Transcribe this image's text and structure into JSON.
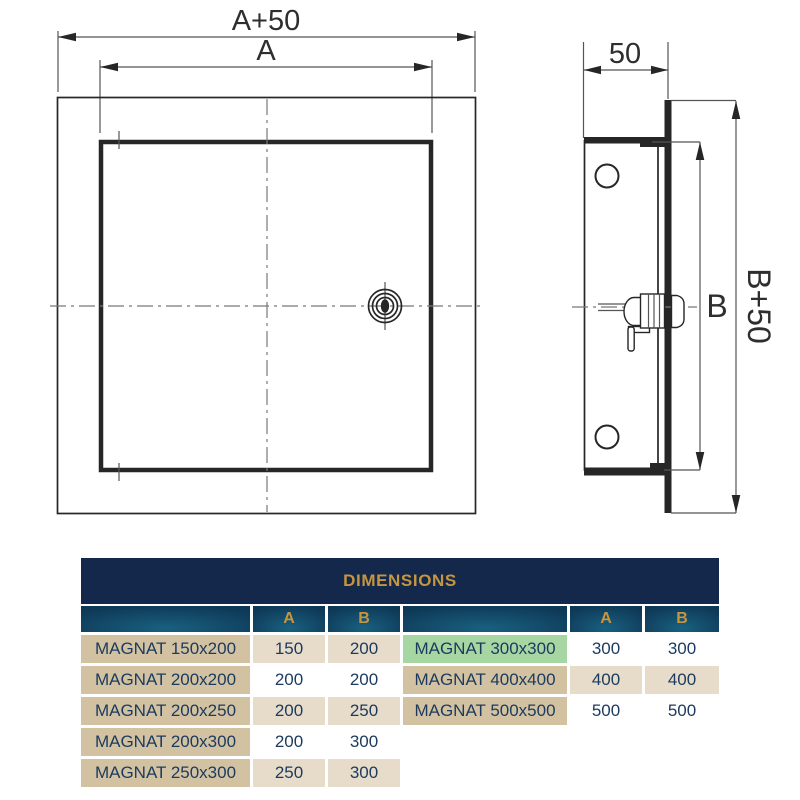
{
  "colors": {
    "navy": "#13284a",
    "gold": "#c6953f",
    "tan-dark": "#d2c2a2",
    "tan-light": "#e6dcc9",
    "green": "#a6d6a2",
    "text-navy": "#1b3a5e",
    "line-dark": "#262626",
    "line-gray": "#555555",
    "header-grad-in": "#19607f",
    "header-grad-mid": "#0e3a58",
    "header-grad-out": "#0d2b4a"
  },
  "drawing": {
    "front_view": {
      "outer_dim_label": "A+50",
      "inner_dim_label": "A"
    },
    "side_view": {
      "depth_dim_label": "50",
      "inner_dim_label": "B",
      "outer_dim_label": "B+50"
    }
  },
  "table": {
    "title": "DIMENSIONS",
    "columns": [
      "A",
      "B"
    ],
    "left_rows": [
      {
        "name": "MAGNAT 150x200",
        "a": "150",
        "b": "200"
      },
      {
        "name": "MAGNAT 200x200",
        "a": "200",
        "b": "200"
      },
      {
        "name": "MAGNAT 200x250",
        "a": "200",
        "b": "250"
      },
      {
        "name": "MAGNAT 200x300",
        "a": "200",
        "b": "300"
      },
      {
        "name": "MAGNAT 250x300",
        "a": "250",
        "b": "300"
      }
    ],
    "right_rows": [
      {
        "name": "MAGNAT 300x300",
        "a": "300",
        "b": "300"
      },
      {
        "name": "MAGNAT 400x400",
        "a": "400",
        "b": "400"
      },
      {
        "name": "MAGNAT 500x500",
        "a": "500",
        "b": "500"
      }
    ]
  }
}
